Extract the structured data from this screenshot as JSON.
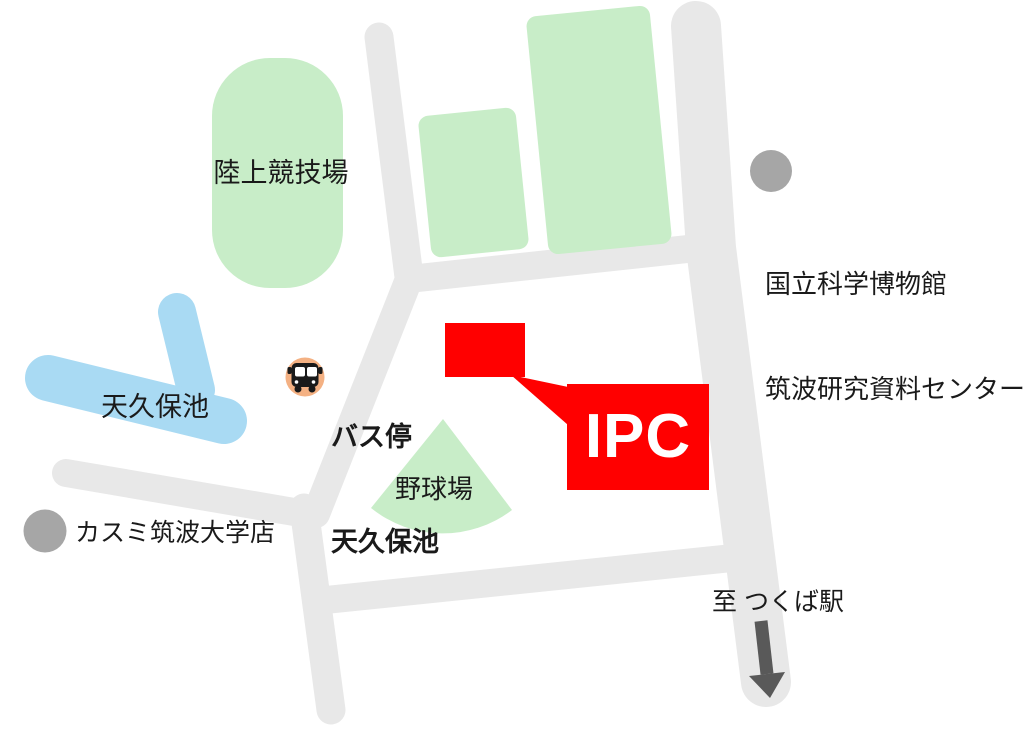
{
  "labels": {
    "athletics_field": "陸上競技場",
    "museum": {
      "line1": "国立科学博物館",
      "line2": "筑波研究資料センター"
    },
    "bus_stop": {
      "line1": "バス停",
      "line2": "天久保池"
    },
    "pond": "天久保池",
    "baseball_field": "野球場",
    "kasumi_store": "カスミ筑波大学店",
    "ipc": "IPC",
    "to_station": "至 つくば駅"
  },
  "colors": {
    "road": "#e8e8e8",
    "green_area": "#c8edc8",
    "water": "#a9daf3",
    "highlight_red": "#ff0000",
    "marker_gray": "#a6a6a6",
    "bus_icon_bg": "#f4b183",
    "bus_icon_glyph": "#1a1a1a",
    "arrow": "#595959",
    "ipc_text": "#ffffff",
    "label_text": "#1a1a1a"
  },
  "icons": {
    "bus": "bus-icon",
    "direction_arrow": "arrow-down-icon",
    "museum_marker": "location-dot",
    "store_marker": "location-dot"
  }
}
